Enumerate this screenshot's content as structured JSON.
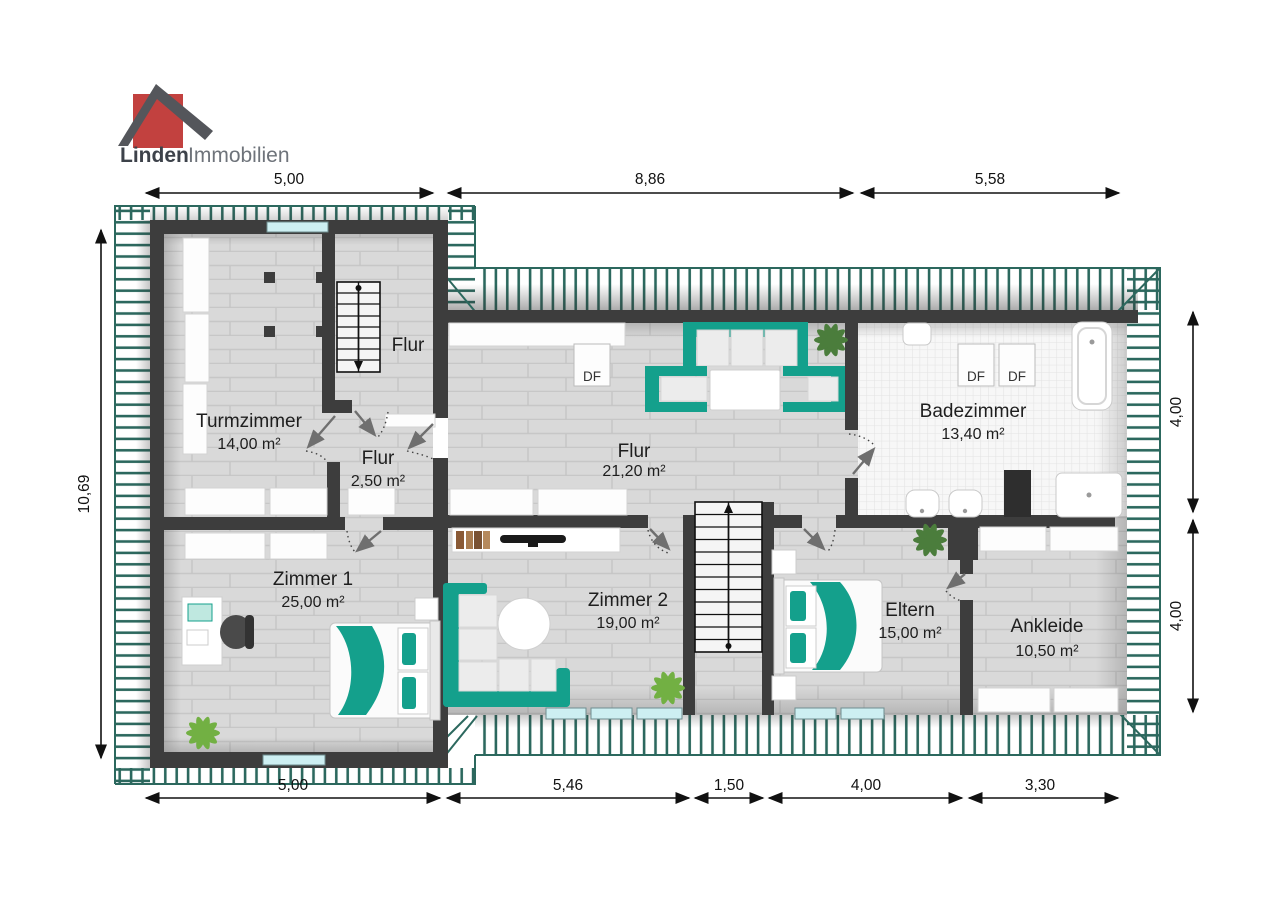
{
  "logo": {
    "brand_bold": "Linden",
    "brand_light": "Immobilien"
  },
  "labels": {
    "skylight": "DF"
  },
  "rooms": {
    "turmzimmer": {
      "name": "Turmzimmer",
      "area": "14,00 m²"
    },
    "flur_upper": {
      "name": "Flur"
    },
    "flur_small": {
      "name": "Flur",
      "area": "2,50 m²"
    },
    "flur_main": {
      "name": "Flur",
      "area": "21,20 m²"
    },
    "badezimmer": {
      "name": "Badezimmer",
      "area": "13,40 m²"
    },
    "zimmer1": {
      "name": "Zimmer 1",
      "area": "25,00 m²"
    },
    "zimmer2": {
      "name": "Zimmer 2",
      "area": "19,00 m²"
    },
    "eltern": {
      "name": "Eltern",
      "area": "15,00 m²"
    },
    "ankleide": {
      "name": "Ankleide",
      "area": "10,50 m²"
    }
  },
  "dimensions": {
    "top": [
      "5,00",
      "8,86",
      "5,58"
    ],
    "bottom": [
      "5,00",
      "5,46",
      "1,50",
      "4,00",
      "3,30"
    ],
    "left": [
      "10,69"
    ],
    "right": [
      "4,00",
      "4,00"
    ]
  },
  "colors": {
    "accent_teal": "#14a08c",
    "hatch_line": "#2c685e",
    "wall": "#3d3d3d",
    "window": "#cdeff2",
    "logo_red": "#c2413f",
    "logo_roof": "#54565b"
  }
}
